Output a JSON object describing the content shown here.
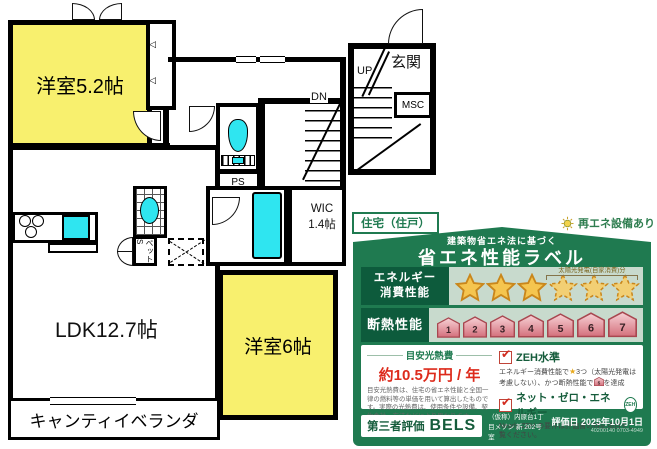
{
  "plan": {
    "room_52": "洋室5.2帖",
    "ldk": "LDK12.7帖",
    "room_6": "洋室6帖",
    "veranda": "キャンティイベランダ",
    "wic_line1": "WIC",
    "wic_line2": "1.4帖",
    "entrance": "玄関",
    "up": "UP",
    "dn": "DN",
    "msc": "MSC",
    "ps": "PS",
    "pet_storage": "ペットS"
  },
  "energy_label": {
    "building_type": "住宅（住戸）",
    "renewable_note": "再エネ設備あり",
    "subtitle": "建築物省エネ法に基づく",
    "title": "省エネ性能ラベル",
    "energy": {
      "label_line1": "エネルギー",
      "label_line2": "消費性能",
      "solar_note": "太陽光発電(自家消費)分",
      "stars_solid": 3,
      "stars_dashed": 3
    },
    "insulation": {
      "label": "断熱性能",
      "grades": [
        "1",
        "2",
        "3",
        "4",
        "5",
        "6",
        "7"
      ]
    },
    "cost": {
      "heading": "目安光熱費",
      "value": "約10.5万円 / 年",
      "note": "目安光熱費は、住宅の省エネ性能と全国一律の燃料等の単価を用いて算出したものです。実際の光熱費は、使用条件や設備、契約会社・方法などにより異なります。"
    },
    "zeh": {
      "level_label": "ZEH水準",
      "desc_pre": "エネルギー消費性能で",
      "desc_star": "★",
      "desc_mid": "3つ（太陽光発電は考慮しない）、かつ断熱性能で",
      "house_grade": "5",
      "desc_post": "を達成",
      "net_zero_label": "ネット・ゼロ・エネルギー",
      "zeh_badge": "ZEH",
      "nearly_note": "Nearly ZEH の要件は評価書の特記項目をご覧ください。"
    },
    "footer": {
      "third_party": "第三者評価",
      "bels": "BELS",
      "property": "（仮称）内原台1丁目メゾン 新 202号室",
      "eval_date": "評価日 2025年10月1日",
      "eval_code": "40200140 0703-4949"
    }
  },
  "icons": {
    "check": "✔",
    "door_mark": "◁"
  },
  "colors": {
    "plan_room_yellow": "#F8F06E",
    "plan_fixture_cyan": "#2FE5F0",
    "label_green": "#1F7A50",
    "label_dark_green": "#0D5B3C",
    "row_bg": "#C8DACD",
    "star_gold": "#F5C54F",
    "badge_pink": "#D4707C",
    "cost_red": "#DD2B1C"
  }
}
